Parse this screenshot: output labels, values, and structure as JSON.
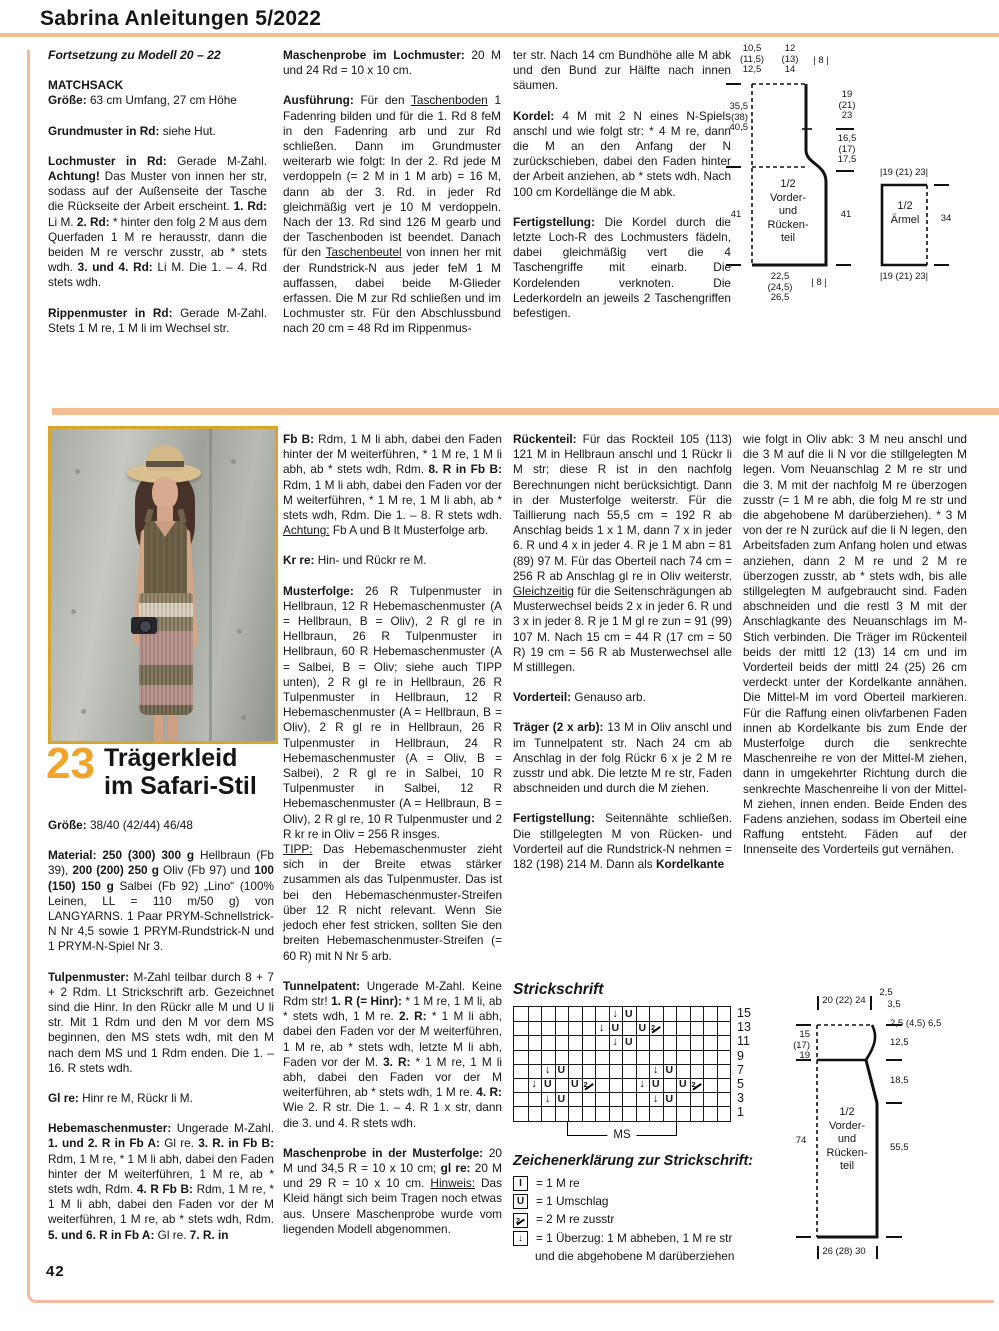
{
  "colors": {
    "accent_orange": "#f0a42c",
    "rule_tan": "#f2bd92",
    "frame_salmon": "#f5b8a0",
    "photo_border_gold": "#d9a52a"
  },
  "header": {
    "title": "Sabrina Anleitungen 5/2022"
  },
  "page_number": "42",
  "article_top": {
    "continuation": "Fortsetzung zu Modell 20 – 22",
    "col1": {
      "title": "MATCHSACK",
      "p_size": [
        {
          "t": "Größe:",
          "b": 1
        },
        {
          "t": " 63 cm Umfang, 27 cm Höhe"
        }
      ],
      "p_grund": [
        {
          "t": "Grundmuster in Rd:",
          "b": 1
        },
        {
          "t": " siehe Hut."
        }
      ],
      "p_loch": [
        {
          "t": "Lochmuster in Rd:",
          "b": 1
        },
        {
          "t": " Gerade M-Zahl. "
        },
        {
          "t": "Achtung!",
          "b": 1
        },
        {
          "t": " Das Muster von innen her str, sodass auf der Außenseite der Tasche die Rückseite der Arbeit erscheint. "
        },
        {
          "t": "1. Rd:",
          "b": 1
        },
        {
          "t": " Li M. "
        },
        {
          "t": "2. Rd:",
          "b": 1
        },
        {
          "t": " * hinter den folg 2 M aus dem Querfaden 1 M re herausstr, dann die beiden M re verschr zusstr, ab * stets wdh. "
        },
        {
          "t": "3. und 4. Rd:",
          "b": 1
        },
        {
          "t": " Li M. Die 1. – 4. Rd stets wdh."
        }
      ],
      "p_rippen": [
        {
          "t": "Rippenmuster in Rd:",
          "b": 1
        },
        {
          "t": " Gerade M-Zahl. Stets 1 M re, 1 M li im Wechsel str."
        }
      ]
    },
    "col2": {
      "p_probe": [
        {
          "t": "Maschenprobe im Lochmuster:",
          "b": 1
        },
        {
          "t": " 20 M und 24 Rd = 10 x 10 cm."
        }
      ],
      "p_ausf": [
        {
          "t": "Ausführung:",
          "b": 1
        },
        {
          "t": " Für den "
        },
        {
          "t": "Taschenboden",
          "u": 1
        },
        {
          "t": " 1 Fadenring bilden und für die 1. Rd 8 feM in den Fadenring arb und zur Rd schließen. Dann im Grundmuster weiterarb wie folgt: In der 2. Rd jede M verdoppeln (= 2 M in 1 M arb) = 16 M, dann ab der 3. Rd. in jeder Rd gleichmäßig vert je 10 M verdoppeln. Nach der 13. Rd sind 126 M gearb und der Taschenboden ist beendet. Danach für den "
        },
        {
          "t": "Taschenbeutel",
          "u": 1
        },
        {
          "t": " von innen her mit der Rundstrick-N aus jeder feM 1 M auffassen, dabei beide M-Glieder erfassen. Die M zur Rd schließen und im Lochmuster str. Für den Abschlussbund nach 20 cm = 48 Rd im Rippenmus-"
        }
      ]
    },
    "col3": {
      "p_cont": [
        {
          "t": "ter str. Nach 14 cm Bundhöhe alle M abk und den Bund zur Hälfte nach innen säumen."
        }
      ],
      "p_kordel": [
        {
          "t": "Kordel:",
          "b": 1
        },
        {
          "t": " 4 M mit 2 N eines N-Spiels anschl und wie folgt str: * 4 M re, dann die M an den Anfang der N zurückschieben, dabei den Faden hinter der Arbeit anziehen, ab * stets wdh. Nach 100 cm Kordellänge die M abk."
        }
      ],
      "p_fertig": [
        {
          "t": "Fertigstellung:",
          "b": 1
        },
        {
          "t": " Die Kordel durch die letzte Loch-R des Lochmusters fädeln, dabei gleichmäßig vert die 4 Taschengriffe mit einarb. Die Kordelenden verknoten. Die Lederkordeln an jeweils 2 Taschengriffen befestigen."
        }
      ]
    }
  },
  "schematic_top": {
    "body_label": "1/2\nVorder-\nund\nRücken-\nteil",
    "top1": "10,5\n(11,5)\n12,5",
    "top2": "12\n(13)\n14",
    "top3": "| 8 |",
    "left1": "35,5\n(38)\n40,5",
    "left2": "41",
    "right1": "19\n(21)\n23",
    "right2": "16,5\n(17)\n17,5",
    "right3": "41",
    "bottom1": "22,5\n(24,5)\n26,5",
    "bottom2": "| 8 |",
    "sleeve_label": "1/2\nÄrmel",
    "sleeve_top": "|19 (21) 23|",
    "sleeve_bottom": "|19 (21) 23|",
    "sleeve_right": "34"
  },
  "article_main": {
    "number": "23",
    "title": "Trägerkleid\nim Safari-Stil",
    "col1": {
      "p_size": [
        {
          "t": "Größe:",
          "b": 1
        },
        {
          "t": " 38/40 (42/44) 46/48"
        }
      ],
      "p_material": [
        {
          "t": "Material: 250 (300) 300 g",
          "b": 1
        },
        {
          "t": " Hellbraun (Fb 39), "
        },
        {
          "t": "200 (200) 250 g",
          "b": 1
        },
        {
          "t": " Oliv (Fb 97) und "
        },
        {
          "t": "100 (150) 150 g",
          "b": 1
        },
        {
          "t": " Salbei (Fb 92) „Lino“ (100% Leinen, LL = 110 m/50 g) von LANGYARNS. 1 Paar PRYM-Schnellstrick-N Nr 4,5 sowie 1 PRYM-Rundstrick-N und 1 PRYM-N-Spiel Nr 3."
        }
      ],
      "p_tulpen": [
        {
          "t": "Tulpenmuster:",
          "b": 1
        },
        {
          "t": " M-Zahl teilbar durch 8 + 7 + 2 Rdm. Lt Strickschrift arb. Gezeichnet sind die Hinr. In den Rückr alle M und U li str. Mit 1 Rdm und den M vor dem MS beginnen, den MS stets wdh, mit den M nach dem MS und 1 Rdm enden. Die 1. – 16. R stets wdh."
        }
      ],
      "p_gl": [
        {
          "t": "Gl re:",
          "b": 1
        },
        {
          "t": " Hinr re M, Rückr li M."
        }
      ],
      "p_hebe": [
        {
          "t": "Hebemaschenmuster:",
          "b": 1
        },
        {
          "t": " Ungerade M-Zahl. "
        },
        {
          "t": "1. und 2. R in Fb A:",
          "b": 1
        },
        {
          "t": " Gl re. "
        },
        {
          "t": "3. R. in Fb B:",
          "b": 1
        },
        {
          "t": " Rdm, 1 M re, * 1 M li abh, dabei den Faden hinter der M weiterführen, 1 M re, ab * stets wdh, Rdm. "
        },
        {
          "t": "4. R Fb B:",
          "b": 1
        },
        {
          "t": " Rdm, 1 M re, * 1 M li abh, dabei den Faden vor der M weiterführen, 1 M re, ab * stets wdh, Rdm. "
        },
        {
          "t": "5. und 6. R in Fb A:",
          "b": 1
        },
        {
          "t": " Gl re. "
        },
        {
          "t": "7. R. in",
          "b": 1
        }
      ]
    },
    "col2": {
      "p_fbb": [
        {
          "t": "Fb B:",
          "b": 1
        },
        {
          "t": " Rdm, 1 M li abh, dabei den Faden hinter der M weiterführen, * 1 M re, 1 M li abh, ab * stets wdh, Rdm. "
        },
        {
          "t": "8. R in Fb B:",
          "b": 1
        },
        {
          "t": " Rdm, 1 M li abh, dabei den Faden vor der M weiterführen, * 1 M re, 1 M li abh, ab * stets wdh, Rdm. Die 1. – 8. R stets wdh. "
        },
        {
          "t": "Achtung:",
          "u": 1
        },
        {
          "t": " Fb A und B lt Musterfolge arb."
        }
      ],
      "p_kr": [
        {
          "t": "Kr re:",
          "b": 1
        },
        {
          "t": " Hin- und Rückr re M."
        }
      ],
      "p_muster": [
        {
          "t": "Musterfolge:",
          "b": 1
        },
        {
          "t": " 26 R Tulpenmuster in Hellbraun, 12 R Hebemaschenmuster (A = Hellbraun, B = Oliv), 2 R gl re in Hellbraun, 26 R Tulpenmuster in Hellbraun, 60 R Hebemaschenmuster (A = Salbei, B = Oliv; siehe auch TIPP unten), 2 R gl re in Hellbraun, 26 R Tulpenmuster in Hellbraun, 12 R Hebemaschenmuster (A = Hellbraun, B = Oliv), 2 R gl re in Hellbraun, 26 R Tulpenmuster in Hellbraun, 24 R Hebemaschenmuster (A = Oliv, B = Salbei), 2 R gl re in Salbei, 10 R Tulpenmuster in Salbei, 12 R Hebemaschenmuster (A = Hellbraun, B = Oliv), 2 R gl re, 10 R Tulpenmuster und 2 R kr re in Oliv = 256 R insges."
        }
      ],
      "p_tipp": [
        {
          "t": "TIPP:",
          "u": 1
        },
        {
          "t": " Das Hebemaschenmuster zieht sich in der Breite etwas stärker zusammen als das Tulpenmuster. Das ist bei den Hebemaschenmuster-Streifen über 12 R nicht relevant. Wenn Sie jedoch eher fest stricken, sollten Sie den breiten Hebemaschenmuster-Streifen (= 60 R) mit N Nr 5 arb."
        }
      ],
      "p_tunnel": [
        {
          "t": "Tunnelpatent:",
          "b": 1
        },
        {
          "t": " Ungerade M-Zahl. Keine Rdm str! "
        },
        {
          "t": "1. R (= Hinr):",
          "b": 1
        },
        {
          "t": " * 1 M re, 1 M li, ab * stets wdh, 1 M re. "
        },
        {
          "t": "2. R:",
          "b": 1
        },
        {
          "t": " * 1 M li abh, dabei den Faden vor der M weiterführen, 1 M re, ab * stets wdh, letzte M li abh, Faden vor der M. "
        },
        {
          "t": "3. R:",
          "b": 1
        },
        {
          "t": " * 1 M re, 1 M li abh, dabei den Faden vor der M weiterführen, ab * stets wdh, 1 M re. "
        },
        {
          "t": "4. R:",
          "b": 1
        },
        {
          "t": " Wie 2. R str. Die 1. – 4. R 1 x str, dann die 3. und 4. R stets wdh."
        }
      ],
      "p_probe": [
        {
          "t": "Maschenprobe in der Musterfolge:",
          "b": 1
        },
        {
          "t": " 20 M und 34,5 R = 10 x 10 cm; "
        },
        {
          "t": "gl re:",
          "b": 1
        },
        {
          "t": " 20 M und 29 R = 10 x 10 cm. "
        },
        {
          "t": "Hinweis:",
          "u": 1
        },
        {
          "t": " Das Kleid hängt sich beim Tragen noch etwas aus. Unsere Maschenprobe wurde vom liegenden Modell abgenommen."
        }
      ]
    },
    "col3": {
      "p_ruecken": [
        {
          "t": "Rückenteil:",
          "b": 1
        },
        {
          "t": " Für das Rockteil 105 (113) 121 M in Hellbraun anschl und 1 Rückr li M str; diese R ist in den nachfolg Berechnungen nicht berücksichtigt. Dann in der Musterfolge weiterstr. Für die Taillierung nach 55,5 cm = 192 R ab Anschlag beids 1 x 1 M, dann 7 x in jeder 6. R und 4 x in jeder 4. R je 1 M abn = 81 (89) 97 M. Für das Oberteil nach 74 cm = 256 R ab Anschlag gl re in Oliv weiterstr. "
        },
        {
          "t": "Gleichzeitig",
          "u": 1
        },
        {
          "t": " für die Seitenschrägungen ab Musterwechsel beids 2 x in jeder 6. R und 3 x in jeder 8. R je 1 M gl re zun = 91 (99) 107 M. Nach 15 cm = 44 R (17 cm = 50 R) 19 cm = 56 R ab Musterwechsel alle M stilllegen."
        }
      ],
      "p_vorder": [
        {
          "t": "Vorderteil:",
          "b": 1
        },
        {
          "t": " Genauso arb."
        }
      ],
      "p_traeger": [
        {
          "t": "Träger (2 x arb):",
          "b": 1
        },
        {
          "t": " 13 M in Oliv anschl und im Tunnelpatent str. Nach 24 cm ab Anschlag in der folg Rückr 6 x je 2 M re zusstr und abk. Die letzte M re str, Faden abschneiden und durch die M ziehen."
        }
      ],
      "p_fertig": [
        {
          "t": "Fertigstellung:",
          "b": 1
        },
        {
          "t": " Seitennähte schließen. Die stillgelegten M von Rücken- und Vorderteil auf die Rundstrick-N nehmen = 182 (198) 214 M. Dann als "
        },
        {
          "t": "Kordelkante",
          "b": 1
        }
      ]
    },
    "col4": {
      "p_kordelkante": [
        {
          "t": "wie folgt in Oliv abk: 3 M neu anschl und die 3 M auf die li N vor die stillgelegten M legen. Vom Neuanschlag 2 M re str und die 3. M mit der nachfolg M re überzogen zusstr (= 1 M re abh, die folg M re str und die abgehobene M darüberziehen). * 3 M von der re N zurück auf die li N legen, den Arbeitsfaden zum Anfang holen und etwas anziehen, dann 2 M re und 2 M re überzogen zusstr, ab * stets wdh, bis alle stillgelegten M aufgebraucht sind. Faden abschneiden und die restl 3 M mit der Anschlagkante des Neuanschlags im M-Stich verbinden. Die Träger im Rückenteil beids der mittl 12 (13) 14 cm und im Vorderteil beids der mittl 24 (25) 26 cm verdeckt unter der Kordelkante annähen. Die Mittel-M im vord Oberteil markieren. Für die Raffung einen olivfarbenen Faden innen ab Kordelkante bis zum Ende der Musterfolge durch die senkrechte Maschenreihe re von der Mittel-M ziehen, dann in umgekehrter Richtung durch die senkrechte Maschenreihe li von der Mittel-M ziehen, innen enden. Beide Enden des Fadens anziehen, sodass im Oberteil eine Raffung entsteht. Fäden auf der Innenseite des Vorderteils gut vernähen."
        }
      ]
    }
  },
  "chart": {
    "type": "knitting-chart",
    "title": "Strickschrift",
    "columns": 16,
    "row_labels": [
      "15",
      "13",
      "11",
      "9",
      "7",
      "5",
      "3",
      "1"
    ],
    "rows": [
      [
        "",
        "",
        "",
        "",
        "",
        "",
        "",
        "d",
        "o",
        "",
        "",
        "",
        "",
        "",
        "",
        ""
      ],
      [
        "",
        "",
        "",
        "",
        "",
        "",
        "d",
        "o",
        "",
        "o",
        "k2",
        "",
        "",
        "",
        "",
        ""
      ],
      [
        "",
        "",
        "",
        "",
        "",
        "",
        "",
        "d",
        "o",
        "",
        "",
        "",
        "",
        "",
        "",
        ""
      ],
      [
        "",
        "",
        "",
        "",
        "",
        "",
        "",
        "",
        "",
        "",
        "",
        "",
        "",
        "",
        "",
        ""
      ],
      [
        "",
        "",
        "d",
        "o",
        "",
        "",
        "",
        "",
        "",
        "",
        "d",
        "o",
        "",
        "",
        "",
        ""
      ],
      [
        "",
        "d",
        "o",
        "",
        "o",
        "k2",
        "",
        "",
        "",
        "d",
        "o",
        "",
        "o",
        "k2",
        "",
        ""
      ],
      [
        "",
        "",
        "d",
        "o",
        "",
        "",
        "",
        "",
        "",
        "",
        "d",
        "o",
        "",
        "",
        "",
        ""
      ],
      [
        "",
        "",
        "",
        "",
        "",
        "",
        "",
        "",
        "",
        "",
        "",
        "",
        "",
        "",
        "",
        ""
      ]
    ],
    "ms_label": "MS",
    "ms_start_col": 5,
    "ms_span": 8,
    "legend_title": "Zeichenerklärung zur Strickschrift:",
    "legend": [
      {
        "sym": "knit",
        "text": "= 1 M re"
      },
      {
        "sym": "yo",
        "text": "= 1 Umschlag"
      },
      {
        "sym": "k2",
        "text": "= 2 M re zusstr"
      },
      {
        "sym": "slip",
        "text": "= 1 Überzug: 1 M abheben, 1 M re str"
      },
      {
        "sym": "",
        "text": "und die abgehobene M darüberziehen"
      }
    ]
  },
  "schematic_bottom": {
    "body_label": "1/2\nVorder-\nund\nRücken-\nteil",
    "top1": "20 (22) 24",
    "top2": "2,5",
    "top3": "3,5",
    "left1": "15\n(17)\n19",
    "left2": "74",
    "right1": "2,5 (4,5) 6,5",
    "right2": "12,5",
    "right3": "18,5",
    "right4": "55,5",
    "bottom": "26 (28) 30"
  }
}
